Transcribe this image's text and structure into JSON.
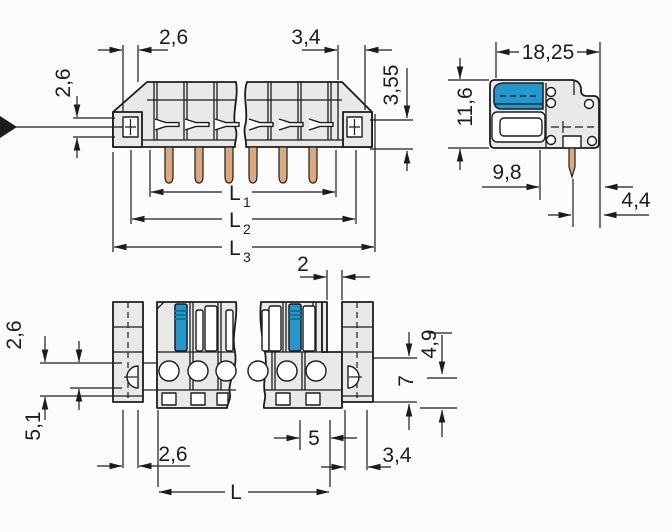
{
  "labels": {
    "front_top_left": "2,6",
    "front_top_right": "3,4",
    "front_right_height": "3,55",
    "front_left_hole": "2,6",
    "front_l1": {
      "base": "L",
      "sub": "1"
    },
    "front_l2": {
      "base": "L",
      "sub": "2"
    },
    "front_l3": {
      "base": "L",
      "sub": "3"
    },
    "side_width": "18,25",
    "side_height": "11,6",
    "side_depth": "9,8",
    "side_pin_edge": "4,4",
    "bottom_gap": "2",
    "bottom_left_hole": "2,6",
    "bottom_left_flange": "5,1",
    "bottom_right_offset": "4,9",
    "bottom_right_flange": "7",
    "bottom_flange_width": "2,6",
    "bottom_last_pitch": "5",
    "bottom_right_edge": "3,4",
    "bottom_length": "L"
  },
  "colors": {
    "line": "#1c1c1c",
    "body_fill": "#e9e9e9",
    "white_fill": "#ffffff",
    "accent_blue": "#2497cc",
    "accent_blue_dark": "#14729e",
    "pin_copper": "#dba97e",
    "background": "#fcfcfc"
  }
}
